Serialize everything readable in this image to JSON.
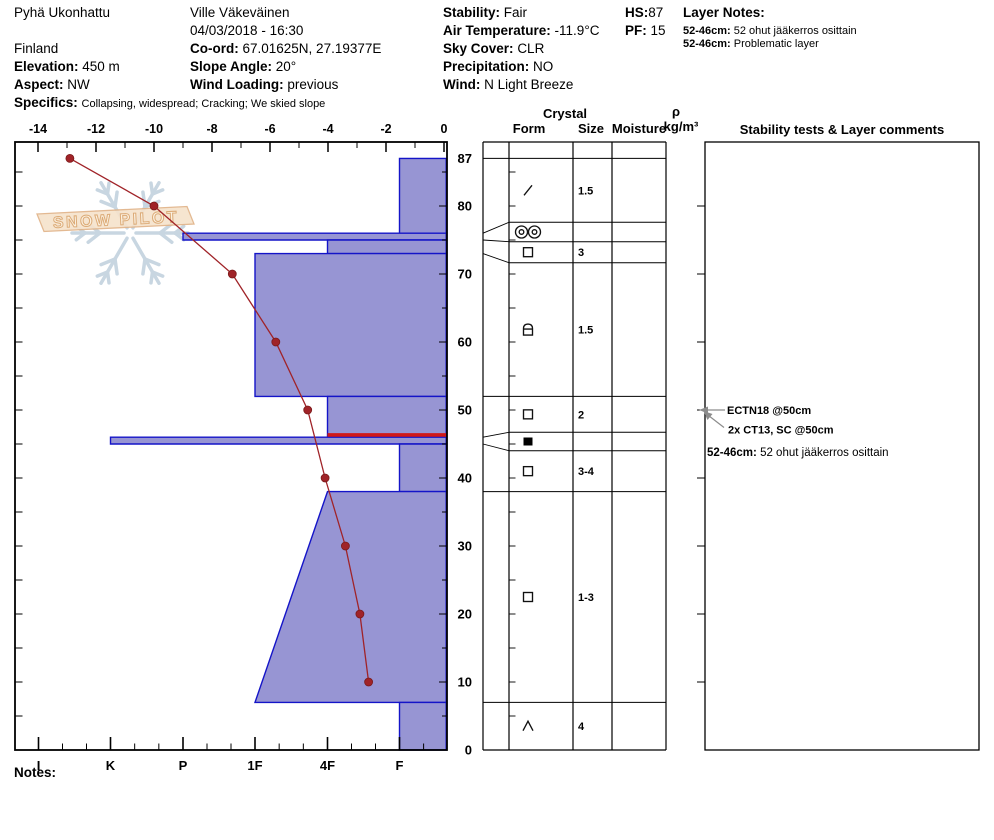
{
  "header": {
    "site": "Pyhä Ukonhattu",
    "country": "Finland",
    "elevation_label": "Elevation:",
    "elevation_value": "450 m",
    "aspect_label": "Aspect:",
    "aspect_value": "NW",
    "specifics_label": "Specifics:",
    "specifics_value": "Collapsing, widespread; Cracking; We skied slope",
    "observer": "Ville Väkeväinen",
    "datetime": "04/03/2018 - 16:30",
    "coord_label": "Co-ord:",
    "coord_value": "67.01625N, 27.19377E",
    "slope_angle_label": "Slope Angle:",
    "slope_angle_value": "20°",
    "wind_loading_label": "Wind Loading:",
    "wind_loading_value": "previous",
    "stability_label": "Stability:",
    "stability_value": "Fair",
    "air_temp_label": "Air Temperature:",
    "air_temp_value": "-11.9°C",
    "sky_label": "Sky Cover:",
    "sky_value": "CLR",
    "precip_label": "Precipitation:",
    "precip_value": "NO",
    "wind_label": "Wind:",
    "wind_value": "N Light Breeze",
    "hs_label": "HS:",
    "hs_value": "87",
    "pf_label": "PF:",
    "pf_value": "15",
    "layer_notes_label": "Layer Notes:",
    "layer_notes": [
      {
        "range": "52-46cm:",
        "text": "52 ohut jääkerros osittain"
      },
      {
        "range": "52-46cm:",
        "text": "Problematic layer"
      }
    ]
  },
  "notes_label": "Notes:",
  "watermark": {
    "text": "SNOW PILOT"
  },
  "chart_data": {
    "type": "snow-profile",
    "depth_axis": {
      "unit": "cm",
      "surface_depth": 87,
      "labels": [
        87,
        80,
        70,
        60,
        50,
        40,
        30,
        20,
        10,
        0
      ]
    },
    "temp_axis": {
      "unit": "°C",
      "ticks": [
        -14,
        -12,
        -10,
        -8,
        -6,
        -4,
        -2,
        0
      ],
      "range": [
        -14,
        0
      ]
    },
    "hardness_axis": {
      "labels": [
        "I",
        "K",
        "P",
        "1F",
        "4F",
        "F"
      ]
    },
    "temperature_profile": [
      {
        "depth": 87,
        "temp": -12.9
      },
      {
        "depth": 80,
        "temp": -10.0
      },
      {
        "depth": 70,
        "temp": -7.3
      },
      {
        "depth": 60,
        "temp": -5.8
      },
      {
        "depth": 50,
        "temp": -4.7
      },
      {
        "depth": 40,
        "temp": -4.1
      },
      {
        "depth": 30,
        "temp": -3.4
      },
      {
        "depth": 20,
        "temp": -2.9
      },
      {
        "depth": 10,
        "temp": -2.6
      }
    ],
    "layers": [
      {
        "top": 87,
        "bottom": 76,
        "hardness": "F",
        "grain_form": "DF",
        "symbol": "slash",
        "grain_size_mm": "1.5"
      },
      {
        "top": 76,
        "bottom": 75,
        "hardness": "P",
        "grain_form": "MFcr",
        "symbol": "double-circle",
        "grain_size_mm": ""
      },
      {
        "top": 75,
        "bottom": 73,
        "hardness": "4F",
        "grain_form": "FC",
        "symbol": "square",
        "grain_size_mm": "3"
      },
      {
        "top": 73,
        "bottom": 52,
        "hardness": "1F",
        "grain_form": "FCxr",
        "symbol": "rounded-square",
        "grain_size_mm": "1.5"
      },
      {
        "top": 52,
        "bottom": 46,
        "hardness": "4F",
        "grain_form": "FC",
        "symbol": "square",
        "grain_size_mm": "2",
        "problem_layer_marker": true
      },
      {
        "top": 46,
        "bottom": 45,
        "hardness": "K",
        "grain_form": "IF",
        "symbol": "filled-square",
        "grain_size_mm": ""
      },
      {
        "top": 45,
        "bottom": 38,
        "hardness": "F",
        "grain_form": "FC",
        "symbol": "square",
        "grain_size_mm": "3-4"
      },
      {
        "top": 38,
        "bottom": 7,
        "hardness_top": "4F",
        "hardness_bottom": "1F",
        "grain_form": "FC",
        "symbol": "square",
        "grain_size_mm": "1-3"
      },
      {
        "top": 7,
        "bottom": 0,
        "hardness": "F",
        "grain_form": "DH",
        "symbol": "caret",
        "grain_size_mm": "4"
      }
    ],
    "table_headers": {
      "crystal": "Crystal",
      "form": "Form",
      "size": "Size",
      "moisture": "Moisture",
      "rho": "ρ",
      "rho_unit": "kg/m³",
      "comments": "Stability tests & Layer comments"
    },
    "stability_tests": [
      {
        "text": "ECTN18 @50cm",
        "depth": 50
      },
      {
        "text": "2x CT13, SC @50cm",
        "depth": 50
      }
    ],
    "layer_comments": [
      {
        "range": "52-46cm:",
        "text": "52 ohut jääkerros osittain"
      }
    ],
    "colors": {
      "bar_fill": "#9795d3",
      "bar_stroke": "#1414c8",
      "temp_line": "#a02328",
      "problem_line": "#d01818",
      "watermark_text": "#eccfa5",
      "watermark_plate": "#f6e3cc",
      "watermark_plate_edge": "#e0b287",
      "watermark_flake": "#c6d4e0",
      "arrow_grey": "#8c8c8c"
    }
  }
}
